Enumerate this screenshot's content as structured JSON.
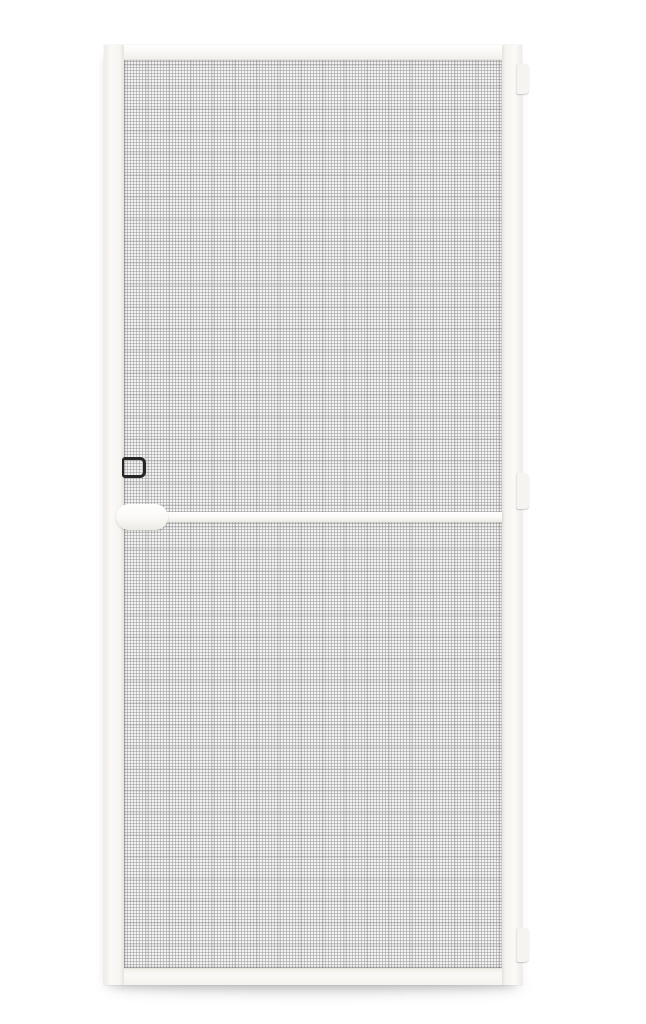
{
  "image": {
    "type": "product-photo",
    "subject": "White aluminium hinged insect screen door with grey mesh on a plain white background"
  },
  "colors": {
    "page_bg": "#ffffff",
    "frame_white": "#faf9f6",
    "frame_edge": "#e7e4de",
    "mesh_base": "#f3f3f3",
    "mesh_line": "rgba(138,138,138,0.45)",
    "mesh_band": "rgba(105,105,105,0.10)",
    "handle_black": "#262626",
    "hinge_white": "#f6f4f0",
    "drop_shadow": "rgba(0,0,0,0.16)"
  },
  "door": {
    "parts": {
      "frame": "white aluminium frame",
      "mesh_upper": "upper mesh panel",
      "mesh_lower": "lower mesh panel",
      "mid_rail": "middle cross rail with rounded end plate",
      "handle": "black pull handle",
      "hinges": [
        "top hinge",
        "middle hinge",
        "bottom hinge"
      ]
    }
  }
}
